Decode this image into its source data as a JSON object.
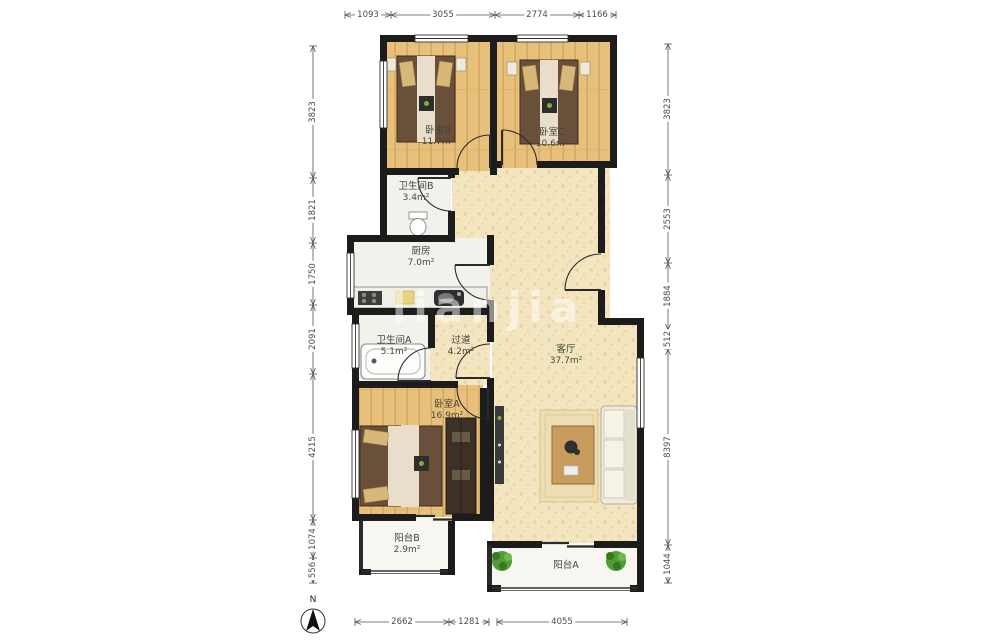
{
  "rooms": {
    "bedroomB": {
      "name": "卧室B",
      "area": "11.7m²"
    },
    "bedroomC": {
      "name": "卧室C",
      "area": "10.6m²"
    },
    "bathB": {
      "name": "卫生间B",
      "area": "3.4m²"
    },
    "kitchen": {
      "name": "厨房",
      "area": "7.0m²"
    },
    "bathA": {
      "name": "卫生间A",
      "area": "5.1m²"
    },
    "passage": {
      "name": "过道",
      "area": "4.2m²"
    },
    "bedroomA": {
      "name": "卧室A",
      "area": "16.9m²"
    },
    "living": {
      "name": "客厅",
      "area": "37.7m²"
    },
    "balconyB": {
      "name": "阳台B",
      "area": "2.9m²"
    },
    "balconyA": {
      "name": "阳台A",
      "area": ""
    }
  },
  "dimensions": {
    "top": [
      "1093",
      "3055",
      "2774",
      "1166"
    ],
    "bottom": [
      "2662",
      "1281",
      "4055"
    ],
    "left": [
      "3823",
      "1821",
      "1750",
      "2091",
      "4215",
      "1074",
      "556"
    ],
    "right": [
      "3823",
      "2553",
      "1884",
      "512",
      "8397",
      "1044"
    ]
  },
  "compass": {
    "label": "N"
  },
  "watermark": {
    "text": "lianjia"
  },
  "colors": {
    "wall": "#1c1c1c",
    "wood_floor": "#e7c07b",
    "living_floor": "#f2e5bf",
    "wet_floor": "#f2f1ec",
    "plant": "#4f9c39",
    "bed_blanket": "#69503a",
    "dimension_text": "#4c4c4c"
  }
}
